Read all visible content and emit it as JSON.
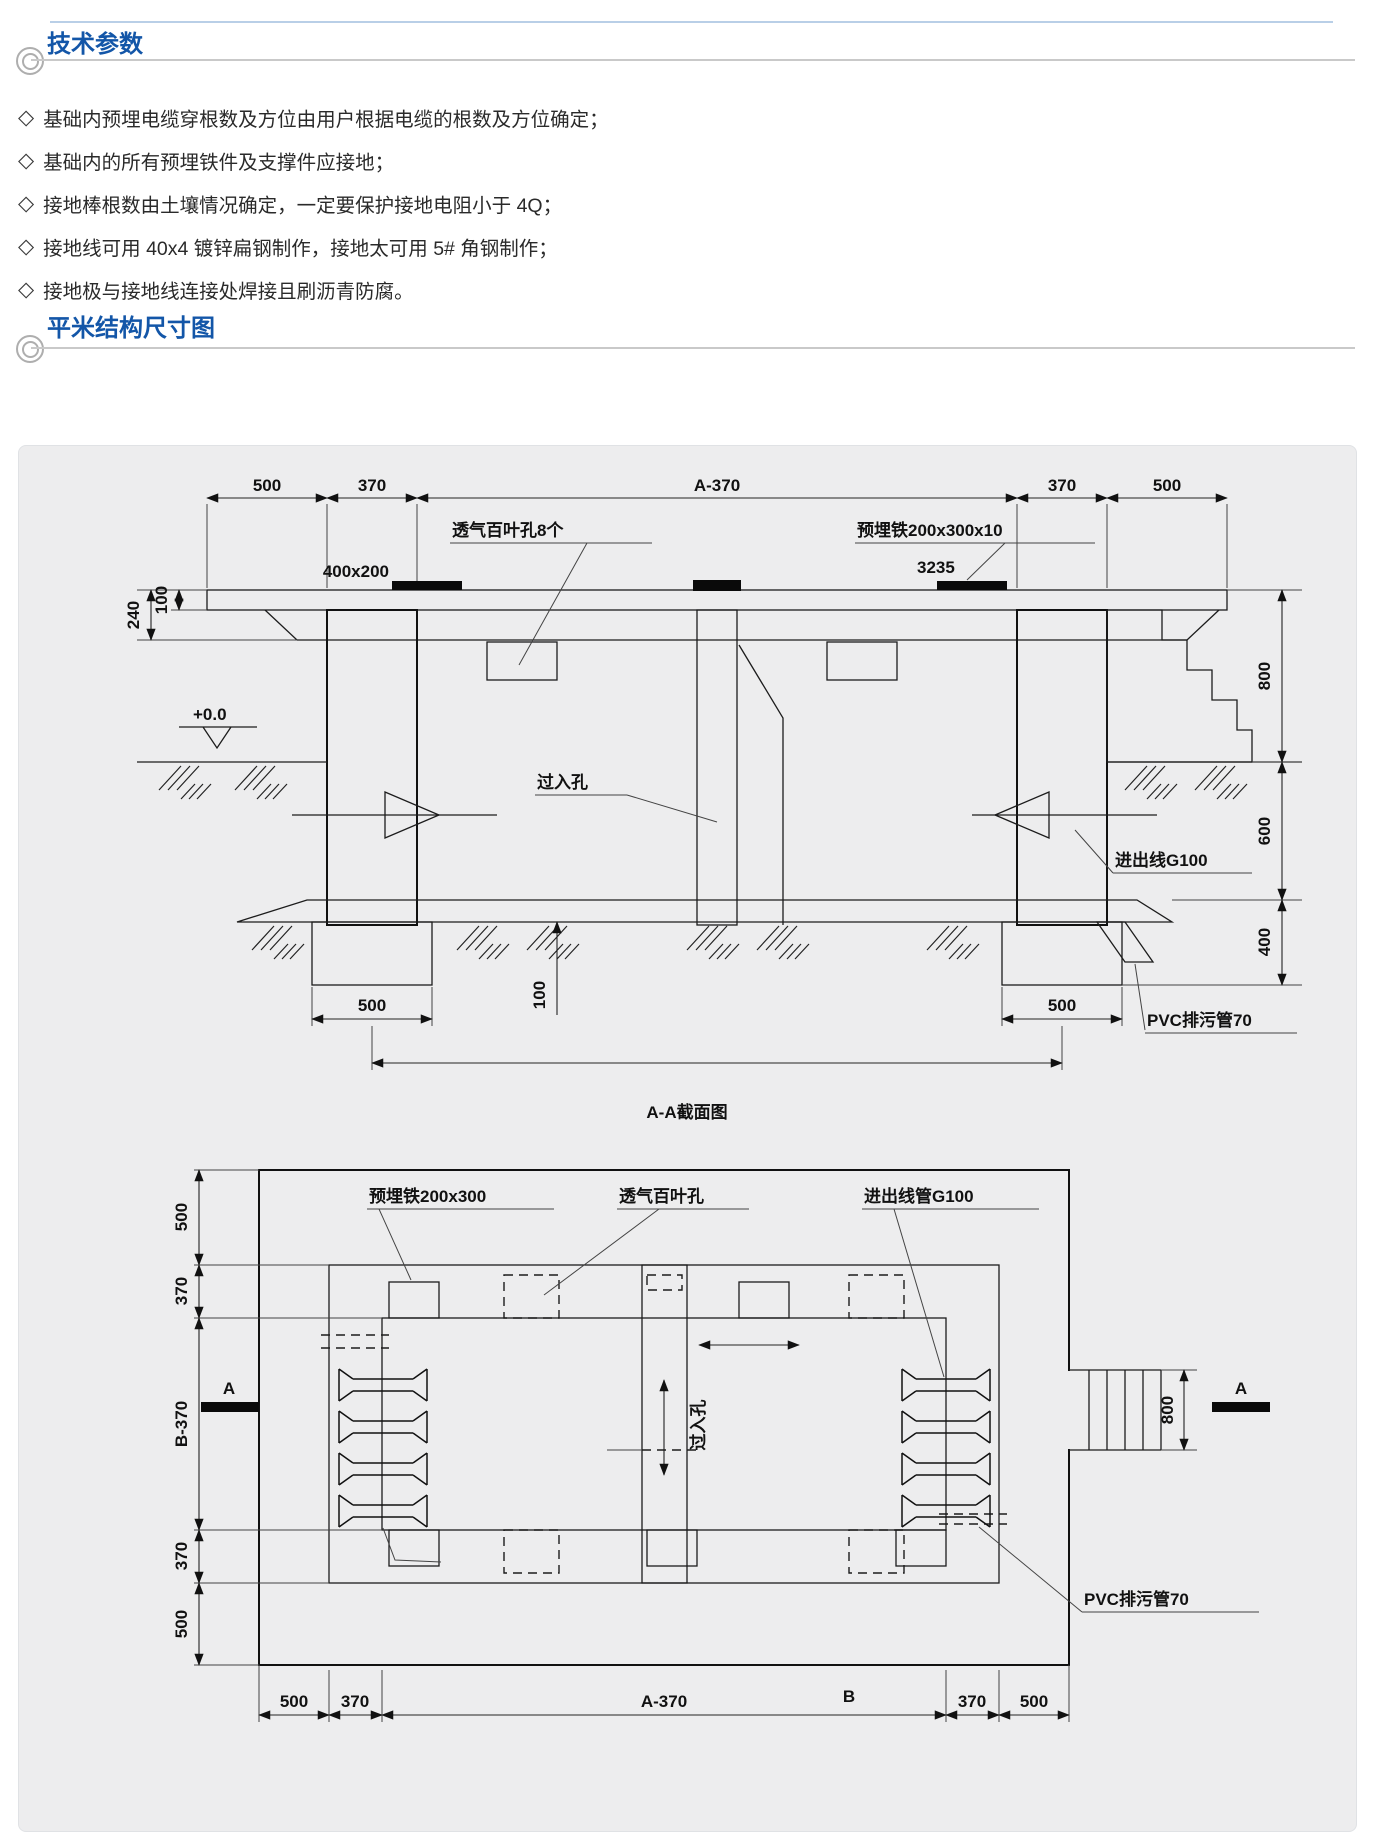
{
  "sec1": {
    "title": "技术参数",
    "bullet": "◇",
    "items": [
      "基础内预埋电缆穿根数及方位由用户根据电缆的根数及方位确定；",
      "基础内的所有预埋铁件及支撑件应接地；",
      "接地棒根数由土壤情况确定，一定要保护接地电阻小于 4Q；",
      "接地线可用 40x4 镀锌扁钢制作，接地太可用 5# 角钢制作；",
      "接地极与接地线连接处焊接且刷沥青防腐。"
    ]
  },
  "sec2": {
    "title": "平米结构尺寸图"
  },
  "d1": {
    "title": "A-A截面图",
    "dims": {
      "t500a": "500",
      "t370a": "370",
      "ta370": "A-370",
      "t370b": "370",
      "t500b": "500",
      "l100": "100",
      "l240": "240",
      "r800": "800",
      "r600": "600",
      "r400": "400",
      "f500a": "500",
      "f500b": "500",
      "b100": "100"
    },
    "labels": {
      "vent": "透气百叶孔8个",
      "embed": "预埋铁200x300x10",
      "num": "3235",
      "plate": "400x200",
      "level": "+0.0",
      "access": "过入孔",
      "gline": "进出线G100",
      "pvc": "PVC排污管70"
    }
  },
  "d2": {
    "labels": {
      "embed": "预埋铁200x300",
      "vent": "透气百叶孔",
      "gline": "进出线管G100",
      "access": "过入孔",
      "pvc": "PVC排污管70"
    },
    "dims": {
      "l500a": "500",
      "l370a": "370",
      "lb370": "B-370",
      "l370b": "370",
      "l500b": "500",
      "b500a": "500",
      "b370a": "370",
      "ba370": "A-370",
      "b370b": "370",
      "b500b": "500",
      "r800": "800"
    },
    "markers": {
      "a": "A",
      "a2": "A",
      "b": "B"
    }
  }
}
